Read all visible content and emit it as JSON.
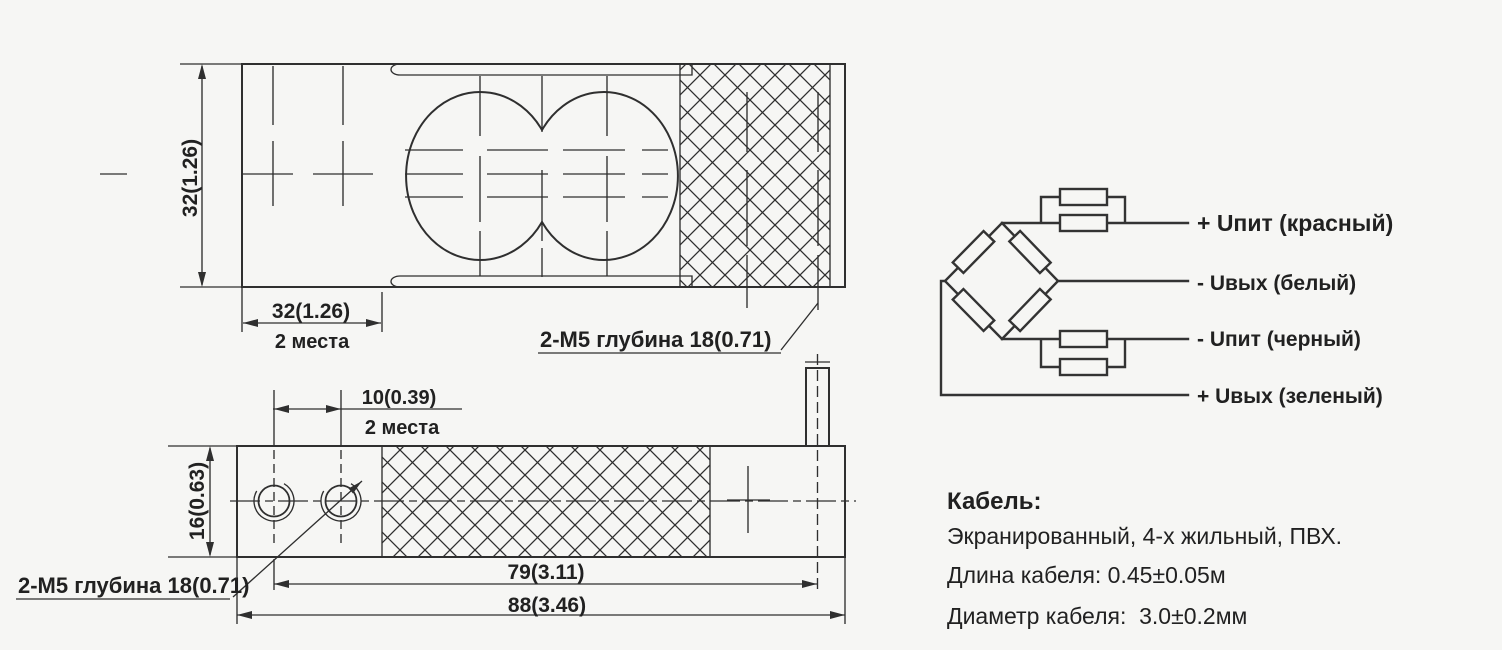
{
  "colors": {
    "background": "#f6f6f4",
    "line": "#2f2f2f",
    "text": "#212121"
  },
  "top_view": {
    "height_dim": "32(1.26)",
    "edge_dim": "32(1.26)",
    "edge_dim_note": "2 места",
    "thread_callout": "2-М5 глубина 18(0.71)"
  },
  "side_view": {
    "hole_spacing_dim": "10(0.39)",
    "hole_spacing_note": "2 места",
    "height_dim": "16(0.63)",
    "thread_callout": "2-М5 глубина 18(0.71)",
    "cable_position_dim": "79(3.11)",
    "length_dim": "88(3.46)"
  },
  "bridge": {
    "wire_labels": [
      "+ Uпит (красный)",
      "- Uвых (белый)",
      "- Uпит (черный)",
      "+ Uвых (зеленый)"
    ]
  },
  "cable": {
    "title": "Кабель:",
    "type_line": "Экранированный, 4-х жильный, ПВХ.",
    "length_line": "Длина кабеля: 0.45±0.05м",
    "diameter_line": "Диаметр кабеля:  3.0±0.2мм"
  }
}
